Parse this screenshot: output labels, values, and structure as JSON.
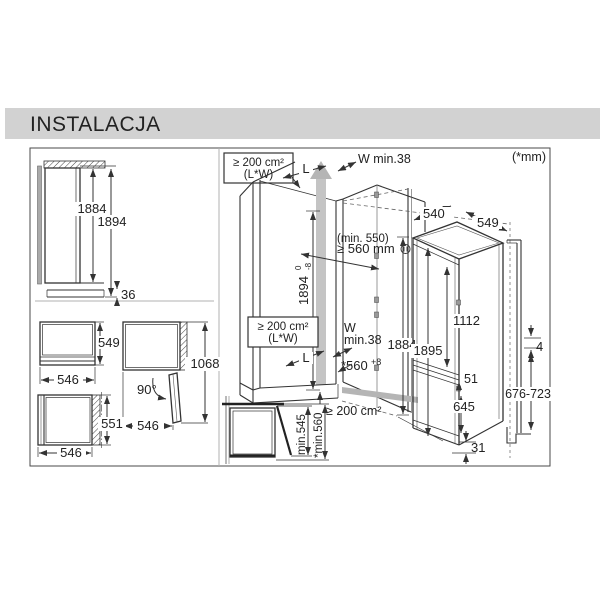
{
  "header": {
    "title": "INSTALACJA"
  },
  "note_units": "(*mm)",
  "colors": {
    "title_bar": "#d2d2d2",
    "line": "#333333",
    "shade": "#b5b5b5"
  },
  "side_view": {
    "appliance_height": "1884",
    "total_height": "1894",
    "plinth_height": "36"
  },
  "top_views": {
    "closed": {
      "depth": "549",
      "width": "546"
    },
    "door_open": {
      "angle": "90°",
      "width": "546",
      "total_depth": "1068"
    },
    "with_door": {
      "depth": "551",
      "width": "546"
    }
  },
  "niche": {
    "vent_area_top": {
      "line1": "≥ 200 cm²",
      "line2": "(L*W)"
    },
    "length_label": "L",
    "wall_clearance": "W min.38",
    "depth_note": "(min. 550)",
    "depth_min": "≥ 560 mm",
    "height": {
      "value": "1894",
      "tol_plus": "0",
      "tol_minus": "-8"
    },
    "vent_area_mid": {
      "line1": "≥ 200 cm²",
      "line2": "(L*W)"
    },
    "wall_clearance2": {
      "line1": "W",
      "line2": "min.38"
    },
    "length_label2": "L",
    "width": {
      "value": "*560",
      "tol": "+8"
    },
    "vent_area_bottom": "≥ 200 cm²",
    "appliance_height": "1884"
  },
  "door_clearance": {
    "min_wall": "min.545",
    "min_niche": "*min.560"
  },
  "appliance": {
    "depth": "540",
    "width": "549",
    "upper_door_height": "1112",
    "niche_height": "1895",
    "hinge_gap": "51",
    "lower_door_height": "645",
    "bottom_gap": "31"
  },
  "panel": {
    "top_gap": "4",
    "handle_range": "676-723"
  }
}
